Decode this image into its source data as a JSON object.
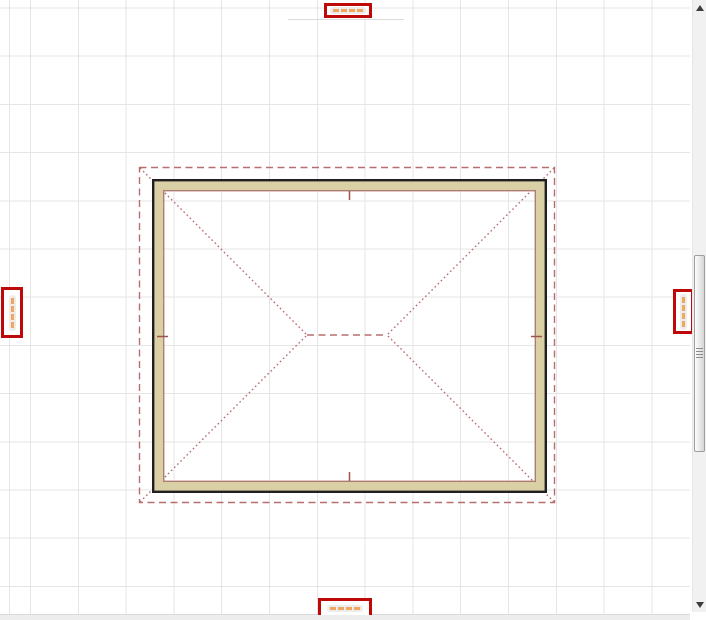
{
  "app": {
    "type": "cad-floor-plan-editor",
    "view": "roof-plan"
  },
  "canvas": {
    "background_color": "#ffffff",
    "grid_color": "#e5e5e5",
    "grid_spacing_px": 48
  },
  "drawing": {
    "walls": {
      "fill_color": "#d9d0a6",
      "outer_edge_color": "#1f1f1f",
      "inner_edge_color": "#b07b70"
    },
    "roof": {
      "line_color": "#b76e6e",
      "overhang_style": "dashed",
      "hip_style": "dotted",
      "ridge_style": "dashed"
    },
    "midpoint_tick_color": "#9c544c"
  },
  "dimension_labels": {
    "highlight_border_color": "#bf0909",
    "text_mark_color": "#f2a55c",
    "pill_color": "#ececec",
    "top": {
      "marks": 4,
      "orientation": "horizontal"
    },
    "bottom": {
      "marks": 4,
      "orientation": "horizontal"
    },
    "left": {
      "marks": 4,
      "orientation": "vertical"
    },
    "right": {
      "marks": 4,
      "orientation": "vertical"
    }
  },
  "scrollbar": {
    "orientation": "vertical",
    "track_color": "#f1f1f1",
    "thumb_position": "upper-middle"
  }
}
